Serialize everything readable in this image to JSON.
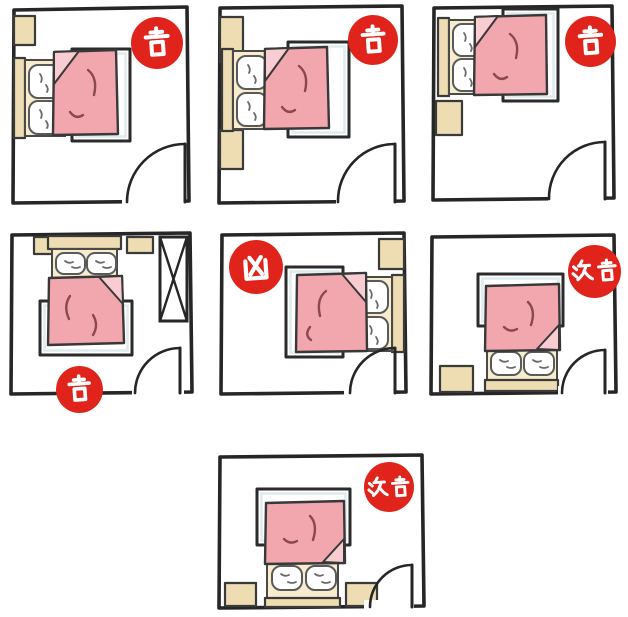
{
  "diagram": {
    "type": "feng-shui-bedroom-bed-placement-layouts",
    "grid": "three rooms top row, three rooms middle row, one room bottom center",
    "badge_style": {
      "background": "#e0241b",
      "text": "#ffffff"
    },
    "palette": {
      "wall_ink": "#262626",
      "blanket_pink": "#f2a7ae",
      "blanket_fold_pink": "#f8ccd1",
      "sheet_cream": "#f8ecce",
      "wood_tan": "#eedcb2",
      "crease_maroon": "#8a4850"
    },
    "legend": [
      {
        "character": "吉",
        "meaning": "auspicious"
      },
      {
        "character": "凶",
        "meaning": "inauspicious"
      },
      {
        "character": "次吉",
        "meaning": "second-best"
      }
    ],
    "rooms": [
      {
        "position": "row1-col1",
        "badge": "吉",
        "badge_meaning": "auspicious",
        "bed": "headboard-on-left-wall",
        "nightstands": 1,
        "door": "bottom-right"
      },
      {
        "position": "row1-col2",
        "badge": "吉",
        "badge_meaning": "auspicious",
        "bed": "headboard-on-left-wall",
        "nightstands": 2,
        "door": "bottom-right"
      },
      {
        "position": "row1-col3",
        "badge": "吉",
        "badge_meaning": "auspicious",
        "bed": "headboard-left-in-top-corner",
        "nightstands": 1,
        "door": "bottom-right"
      },
      {
        "position": "row2-col1",
        "badge": "吉",
        "badge_meaning": "auspicious",
        "bed": "headboard-on-top-wall",
        "nightstands": 2,
        "wardrobe": "right-wall",
        "door": "bottom-right"
      },
      {
        "position": "row2-col2",
        "badge": "凶",
        "badge_meaning": "inauspicious",
        "bed": "headboard-on-right-wall",
        "nightstands": 1,
        "door": "bottom-right"
      },
      {
        "position": "row2-col3",
        "badge": "次吉",
        "badge_meaning": "second-best",
        "bed": "headboard-toward-bottom-wall",
        "nightstands": 1,
        "door": "bottom-right"
      },
      {
        "position": "row3-center",
        "badge": "次吉",
        "badge_meaning": "second-best",
        "bed": "headboard-toward-bottom-wall",
        "nightstands": 2,
        "door": "bottom-right"
      }
    ]
  }
}
